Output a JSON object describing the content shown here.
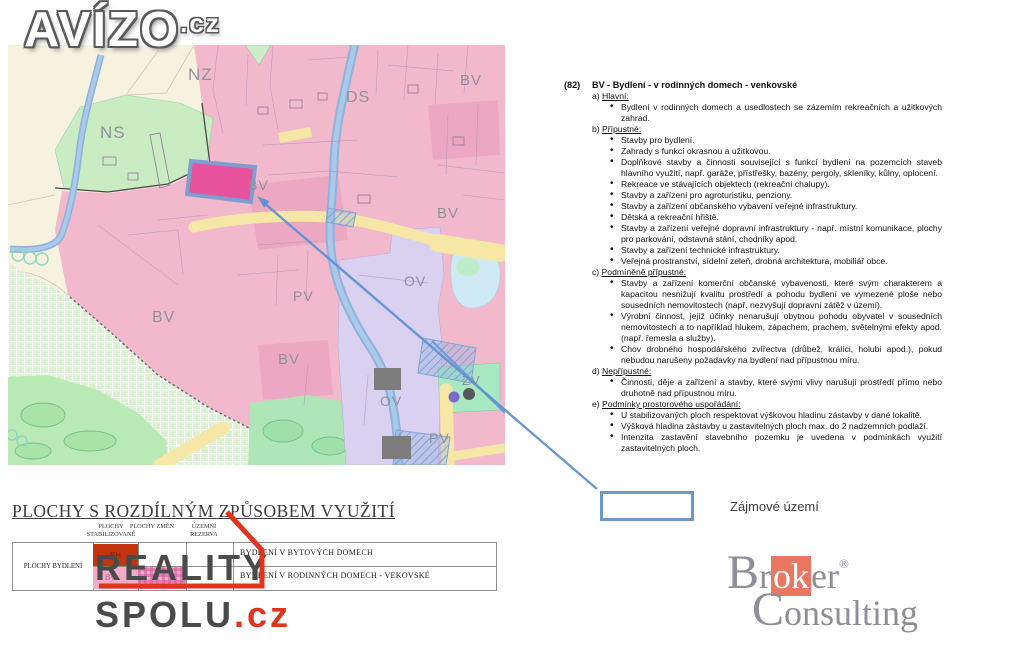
{
  "branding": {
    "avizo": {
      "text": "AVÍZO",
      "tld": ".cz"
    },
    "reality_spolu": {
      "line1": "REALITY",
      "line2": "SPOLU",
      "tld": ".cz"
    },
    "broker": {
      "line1_pre": "Br",
      "line1_mid": "ok",
      "line1_post": "er",
      "reg": "®",
      "line2": "Consulting"
    }
  },
  "map": {
    "labels": [
      {
        "text": "NZ"
      },
      {
        "text": "NS"
      },
      {
        "text": "DS"
      },
      {
        "text": "BV"
      },
      {
        "text": "BV"
      },
      {
        "text": "BV"
      },
      {
        "text": "BV"
      },
      {
        "text": "BV"
      },
      {
        "text": "PV"
      },
      {
        "text": "OV"
      },
      {
        "text": "OV"
      },
      {
        "text": "ZV"
      },
      {
        "text": "PV"
      }
    ],
    "colors": {
      "highlight_parcel": "#e8519b",
      "parcel_border": "#7e9ecf",
      "arrow": "#5e90d2",
      "bv_pink": "#f2b9cd",
      "ns_green": "#c9ecc2",
      "road_yellow": "#f6e7a6",
      "river_blue": "#9dbfe2",
      "ov_purple": "#d9d1ef"
    }
  },
  "callout": {
    "label": "Zájmové území"
  },
  "regulations": {
    "code": "(82)",
    "title": "BV - Bydlení - v rodinných domech - venkovské",
    "sections": [
      {
        "prefix": "a)",
        "label": "Hlavní:",
        "items": [
          "Bydlení v rodinných domech a usedlostech se zázemím rekreačních a užitkových zahrad."
        ]
      },
      {
        "prefix": "b)",
        "label": "Přípustné:",
        "items": [
          "Stavby pro bydlení.",
          "Zahrady s funkcí okrasnou a užitkovou.",
          "Doplňkové stavby a činnosti související s funkcí bydlení na pozemcích staveb hlavního využití, např. garáže, přístřešky, bazény, pergoly, skleníky, kůlny, oplocení.",
          "Rekreace ve stávajících objektech (rekreační chalupy).",
          "Stavby a zařízení pro agroturistiku, penziony.",
          "Stavby a zařízení občanského vybavení veřejné infrastruktury.",
          "Dětská a rekreační hřiště.",
          "Stavby a zařízení veřejné dopravní infrastruktury - např. místní komunikace, plochy pro parkování, odstavná stání, chodníky apod.",
          "Stavby a zařízení technické infrastruktury.",
          "Veřejná prostranství, sídelní zeleň, drobná architektura, mobiliář obce."
        ]
      },
      {
        "prefix": "c)",
        "label": "Podmíněně přípustné:",
        "items": [
          "Stavby a zařízení komerční občanské vybavenosti, které svým charakterem a kapacitou nesnižují kvalitu prostředí a pohodu bydlení ve vymezené ploše nebo sousedních nemovitostech (např. nezvyšují dopravní zátěž v území).",
          "Výrobní činnost, jejíž účinky nenarušují obytnou pohodu obyvatel v sousedních nemovitostech a to například hlukem, zápachem, prachem, světelnými efekty apod. (např. řemesla a služby).",
          "Chov drobného hospodářského zvířectva (drůbež, králíci, holubi apod.), pokud nebudou narušeny požadavky na bydlení nad přípustnou míru."
        ]
      },
      {
        "prefix": "d)",
        "label": "Nepřípustné:",
        "items": [
          "Činnosti, děje a zařízení a stavby, které svými vlivy narušují prostředí přímo nebo druhotně nad přípustnou míru."
        ]
      },
      {
        "prefix": "e)",
        "label": "Podmínky prostorového uspořádání:",
        "items": [
          "U stabilizovaných ploch respektovat výškovou hladinu zástavby v dané lokalitě.",
          "Výšková hladina zástavby u zastavitelných ploch max. do 2 nadzemních podlaží.",
          "Intenzita zastavění stavebního pozemku je uvedena v podmínkách využití zastavitelných ploch."
        ]
      }
    ]
  },
  "legend": {
    "title": "PLOCHY S ROZDÍLNÝM ZPŮSOBEM VYUŽITÍ",
    "col_headers": [
      "PLOCHY STABILIZOVANÉ",
      "PLOCHY ZMĚN",
      "ÚZEMNÍ REZERVA"
    ],
    "row_label": "PLOCHY BYDLENÍ",
    "swatch_bh": "BH",
    "swatch_bv": "BV",
    "rows": [
      "BYDLENÍ V BYTOVÝCH DOMECH",
      "BYDLENÍ V RODINNÝCH DOMECH - VEKOVSKÉ"
    ],
    "colors": {
      "bh_red": "#c2340e",
      "bv_pink": "#f3abc9"
    }
  }
}
